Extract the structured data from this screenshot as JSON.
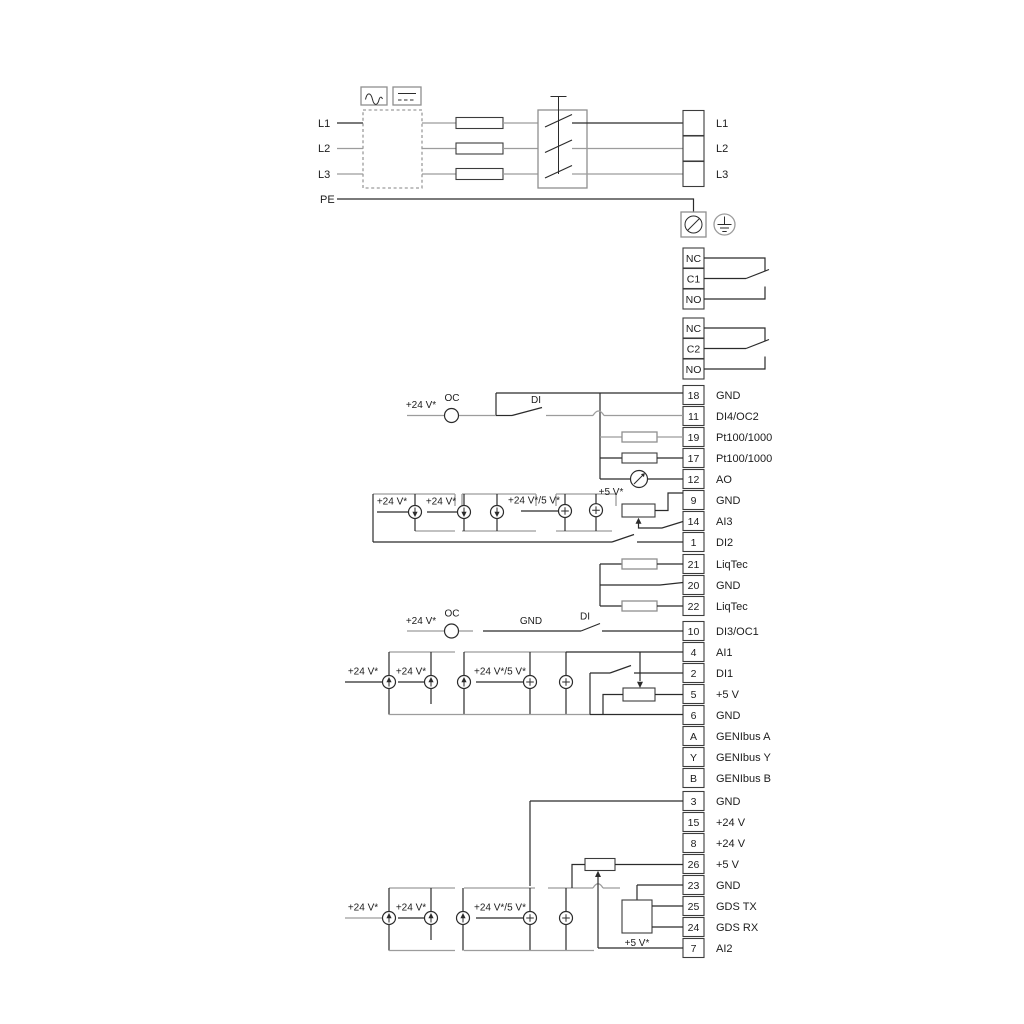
{
  "mains": {
    "inputs": [
      "L1",
      "L2",
      "L3",
      "PE"
    ],
    "outputs": [
      "L1",
      "L2",
      "L3"
    ]
  },
  "relay1": {
    "rows": [
      "NC",
      "C1",
      "NO"
    ]
  },
  "relay2": {
    "rows": [
      "NC",
      "C2",
      "NO"
    ]
  },
  "labels": {
    "v24": "+24 V*",
    "v24v5": "+24 V*/5 V*",
    "v5": "+5 V*",
    "oc": "OC",
    "di": "DI",
    "gnd": "GND"
  },
  "b1": {
    "terminals": [
      {
        "n": "18",
        "label": "GND"
      },
      {
        "n": "11",
        "label": "DI4/OC2"
      },
      {
        "n": "19",
        "label": "Pt100/1000"
      },
      {
        "n": "17",
        "label": "Pt100/1000"
      },
      {
        "n": "12",
        "label": "AO"
      },
      {
        "n": "9",
        "label": "GND"
      },
      {
        "n": "14",
        "label": "AI3"
      },
      {
        "n": "1",
        "label": "DI2"
      }
    ]
  },
  "b2": {
    "terminals": [
      {
        "n": "21",
        "label": "LiqTec"
      },
      {
        "n": "20",
        "label": "GND"
      },
      {
        "n": "22",
        "label": "LiqTec"
      }
    ]
  },
  "b3": {
    "terminals": [
      {
        "n": "10",
        "label": "DI3/OC1"
      },
      {
        "n": "4",
        "label": "AI1"
      },
      {
        "n": "2",
        "label": "DI1"
      },
      {
        "n": "5",
        "label": "+5 V"
      },
      {
        "n": "6",
        "label": "GND"
      },
      {
        "n": "A",
        "label": "GENIbus A"
      },
      {
        "n": "Y",
        "label": "GENIbus Y"
      },
      {
        "n": "B",
        "label": "GENIbus B"
      }
    ]
  },
  "b4": {
    "terminals": [
      {
        "n": "3",
        "label": "GND"
      },
      {
        "n": "15",
        "label": "+24 V"
      },
      {
        "n": "8",
        "label": "+24 V"
      },
      {
        "n": "26",
        "label": "+5 V"
      },
      {
        "n": "23",
        "label": "GND"
      },
      {
        "n": "25",
        "label": "GDS TX"
      },
      {
        "n": "24",
        "label": "GDS RX"
      },
      {
        "n": "7",
        "label": "AI2"
      }
    ]
  }
}
